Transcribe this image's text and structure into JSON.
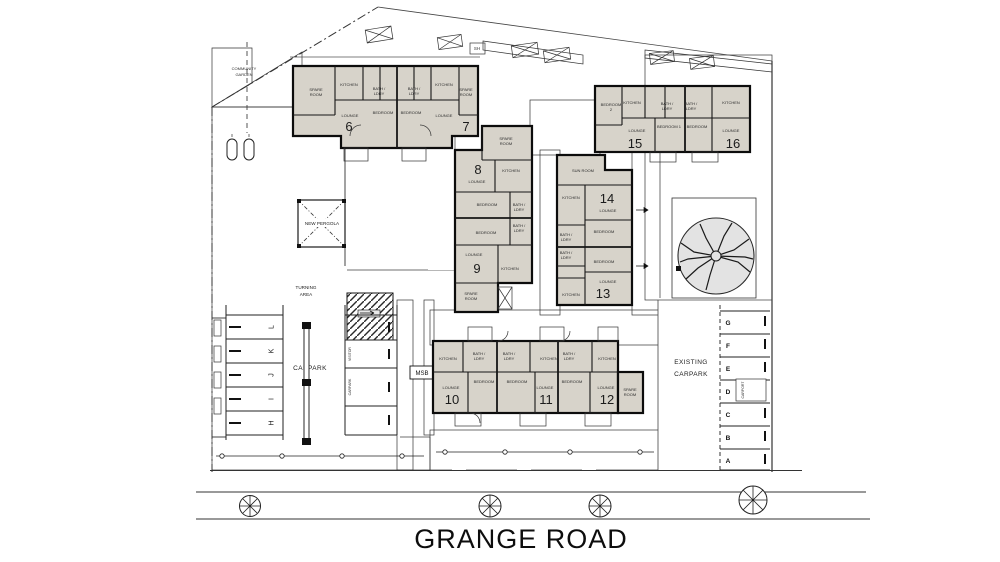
{
  "page": {
    "road_name": "GRANGE ROAD"
  },
  "labels": {
    "community_garden": [
      "COMMUNITY",
      "GARDEN"
    ],
    "new_pergola": "NEW PERGOLA",
    "turning_area": [
      "TURNING",
      "AREA"
    ],
    "carpark": "CARPARK",
    "existing_carpark": [
      "EXISTING",
      "CARPARK"
    ],
    "carport": "CARPORT",
    "msb": "MSB",
    "shed": "SH",
    "visitor_bays": [
      "VISITOR",
      "CARPARK"
    ]
  },
  "carpark_bays": [
    "L",
    "K",
    "J",
    "I",
    "H"
  ],
  "existing_carpark_bays": [
    "G",
    "F",
    "E",
    "D",
    "C",
    "B",
    "A"
  ],
  "units": [
    "6",
    "7",
    "8",
    "9",
    "10",
    "11",
    "12",
    "13",
    "14",
    "15",
    "16"
  ],
  "rooms": {
    "kitchen": "KITCHEN",
    "lounge": "LOUNGE",
    "bedroom": "BEDROOM",
    "bedroom1": "BEDROOM 1",
    "bedroom2": [
      "BEDROOM",
      "2"
    ],
    "spare": [
      "SPARE",
      "ROOM"
    ],
    "bath": [
      "BATH /",
      "LDRY"
    ],
    "sunroom": "SUN ROOM"
  },
  "colors": {
    "building_fill": "#d7d3ca",
    "hatch_gray": "#cfcfcf",
    "hatch_line": "#8a8a8a",
    "line": "#111111",
    "background": "#ffffff"
  }
}
